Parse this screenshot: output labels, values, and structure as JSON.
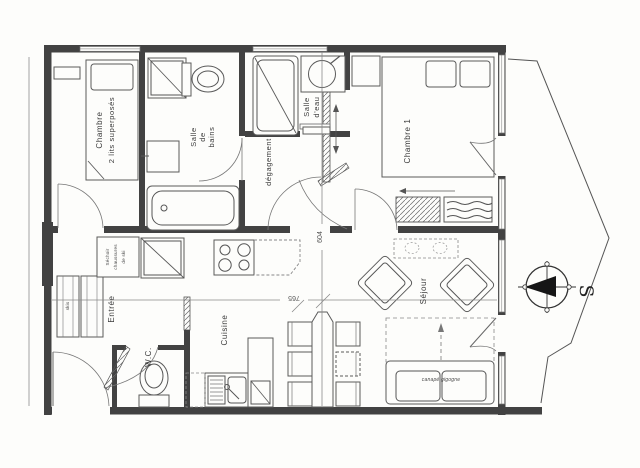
{
  "plan": {
    "rooms": {
      "chambre2": {
        "line1": "Chambre",
        "line2": "2 lits superposés"
      },
      "salle_de_bains": {
        "line1": "Salle",
        "line2": "de",
        "line3": "bains"
      },
      "salle_eau": {
        "line1": "Salle",
        "line2": "d'eau"
      },
      "degagement": {
        "name": "dégagement"
      },
      "chambre1": {
        "name": "Chambre 1"
      },
      "entree": {
        "name": "Entrée"
      },
      "wc": {
        "name": "W.C."
      },
      "cuisine": {
        "name": "Cuisine"
      },
      "sejour": {
        "name": "Séjour"
      }
    },
    "annotations": {
      "sechoir_line1": "Séchoir",
      "sechoir_line2": "chaussures",
      "sechoir_line3": "de ski",
      "skis": "skis",
      "sofa_bed": "canapé gigogne"
    },
    "dimensions": {
      "width_cm": "765",
      "depth_cm": "604"
    },
    "compass": {
      "south_letter": "S"
    },
    "colors": {
      "ink": "#3b3b3b",
      "wall": "#424242",
      "paper": "#fdfdfb"
    }
  }
}
